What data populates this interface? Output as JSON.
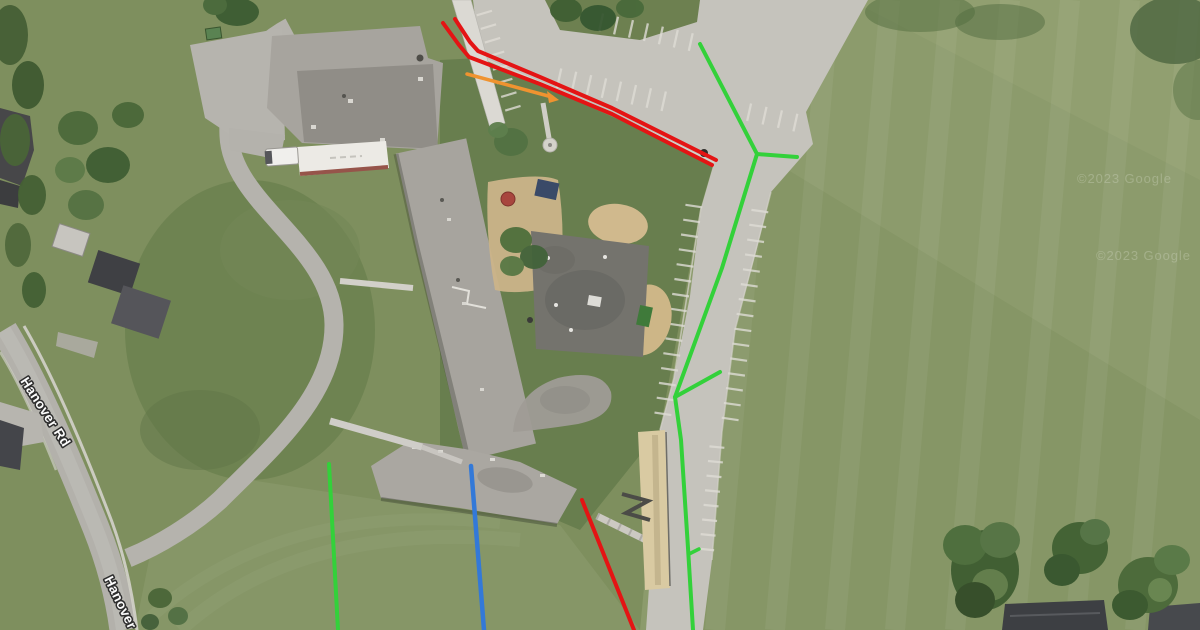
{
  "map": {
    "type": "satellite-imagery",
    "road_labels": [
      {
        "text": "Hanover Rd",
        "x": 20,
        "y": 381,
        "angle": 57
      },
      {
        "text": "Hanover",
        "x": 104,
        "y": 579,
        "angle": 64
      }
    ],
    "watermarks": [
      {
        "text": "©2023 Google",
        "x": 1077,
        "y": 183
      },
      {
        "text": "©2023 Google",
        "x": 1096,
        "y": 260
      }
    ]
  },
  "overlays": {
    "colors": {
      "red": "#e41414",
      "green": "#33d13a",
      "orange": "#ef9330",
      "blue": "#3379d8"
    },
    "lines": [
      {
        "name": "route-red-upper",
        "color": "red",
        "width": 4,
        "points": "455,19 470,42 478,51 540,77 612,108 716,160"
      },
      {
        "name": "route-red-lower",
        "color": "red",
        "width": 4,
        "points": "443,23 459,45 469,57 540,84 612,114 712,165"
      },
      {
        "name": "route-red-south",
        "color": "red",
        "width": 4,
        "points": "582,500 618,590 634,630"
      },
      {
        "name": "route-green-main",
        "color": "green",
        "width": 4,
        "points": "700,44 757,154 722,268 675,397 681,440 688,548 693,630"
      },
      {
        "name": "route-green-branch-east",
        "color": "green",
        "width": 4,
        "points": "757,154 797,157"
      },
      {
        "name": "route-green-branch-northeast",
        "color": "green",
        "width": 4,
        "points": "675,397 720,372"
      },
      {
        "name": "route-green-spur",
        "color": "green",
        "width": 3.5,
        "points": "689,554 699,549"
      },
      {
        "name": "route-green-south-field",
        "color": "green",
        "width": 4,
        "points": "329,464 338,630"
      },
      {
        "name": "route-blue-south",
        "color": "blue",
        "width": 4.5,
        "points": "471,466 484,630"
      },
      {
        "name": "pointer-orange",
        "color": "orange",
        "width": 3.5,
        "points": "467,74 552,97"
      }
    ],
    "markers": [
      {
        "name": "pointer-orange-arrowhead",
        "color": "orange",
        "points": "559,100 547,91 549,103"
      }
    ]
  }
}
